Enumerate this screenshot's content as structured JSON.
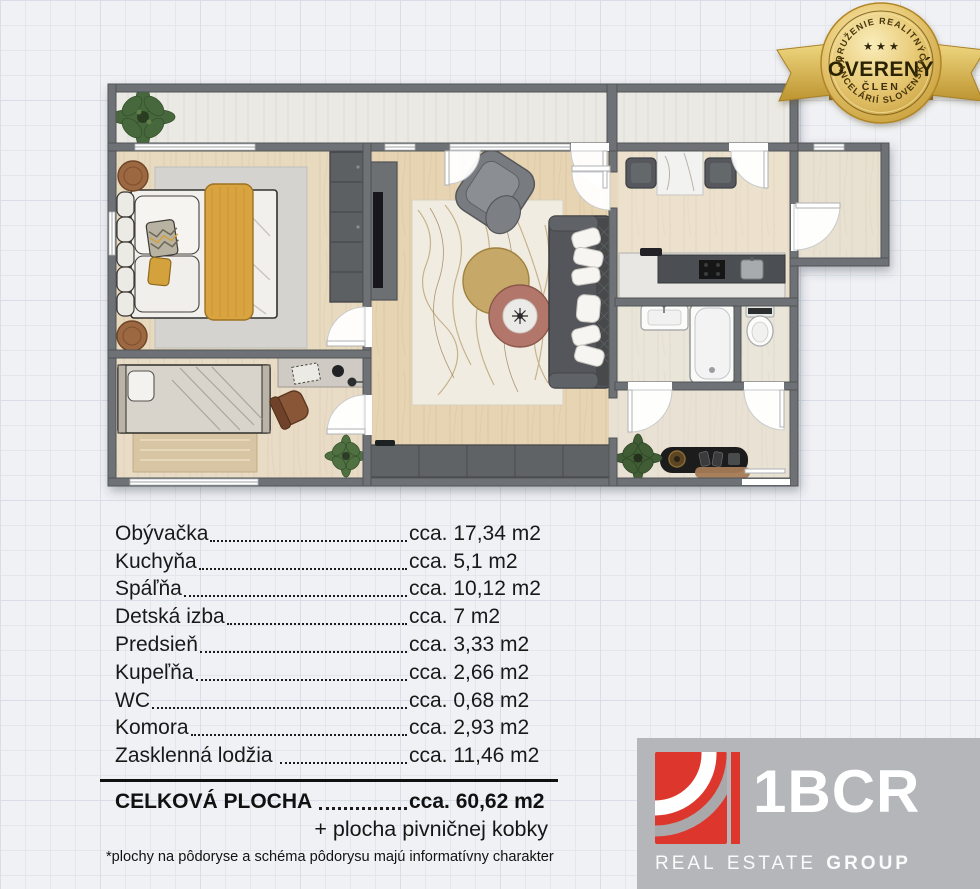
{
  "badge": {
    "arc_top": "ZDRUŽENIE REALITNÝCH",
    "stars": "★ ★ ★",
    "title": "OVERENÝ",
    "member": "ČLEN",
    "arc_bottom": "KANCELÁRIÍ SLOVENSKA"
  },
  "floorplan": {
    "description": "top-down 3D render of a 2-room apartment with furniture",
    "palette": {
      "walls": "#6e7174",
      "wood_floor": "#e7d4b2",
      "light_floor": "#eae5d9",
      "balcony_floor": "#ebe9e3",
      "accent_yellow": "#d9a440",
      "dark_furniture": "#54575b"
    }
  },
  "areas": {
    "items": [
      {
        "name": "Obývačka",
        "value": "cca. 17,34 m2"
      },
      {
        "name": "Kuchyňa",
        "value": "cca. 5,1 m2"
      },
      {
        "name": "Spáľňa",
        "value": "cca. 10,12 m2"
      },
      {
        "name": "Detská izba",
        "value": "cca. 7 m2"
      },
      {
        "name": "Predsieň",
        "value": "cca. 3,33 m2"
      },
      {
        "name": "Kupeľňa",
        "value": "cca. 2,66 m2"
      },
      {
        "name": "WC",
        "value": "cca. 0,68 m2"
      },
      {
        "name": "Komora",
        "value": "cca. 2,93 m2"
      },
      {
        "name": "Zasklenná lodžia ",
        "value": "cca. 11,46 m2"
      }
    ],
    "total": {
      "name": "CELKOVÁ PLOCHA ",
      "value": "cca. 60,62 m2"
    },
    "extra": "+ plocha pivničnej kobky",
    "disclaimer": "*plochy na pôdoryse a schéma pôdorysu majú informatívny charakter"
  },
  "logo": {
    "brand": "1BCR",
    "words": [
      "REAL",
      "ESTATE",
      "GROUP"
    ],
    "accent_red": "#dd372d",
    "box_gray": "#b5b6b9"
  }
}
